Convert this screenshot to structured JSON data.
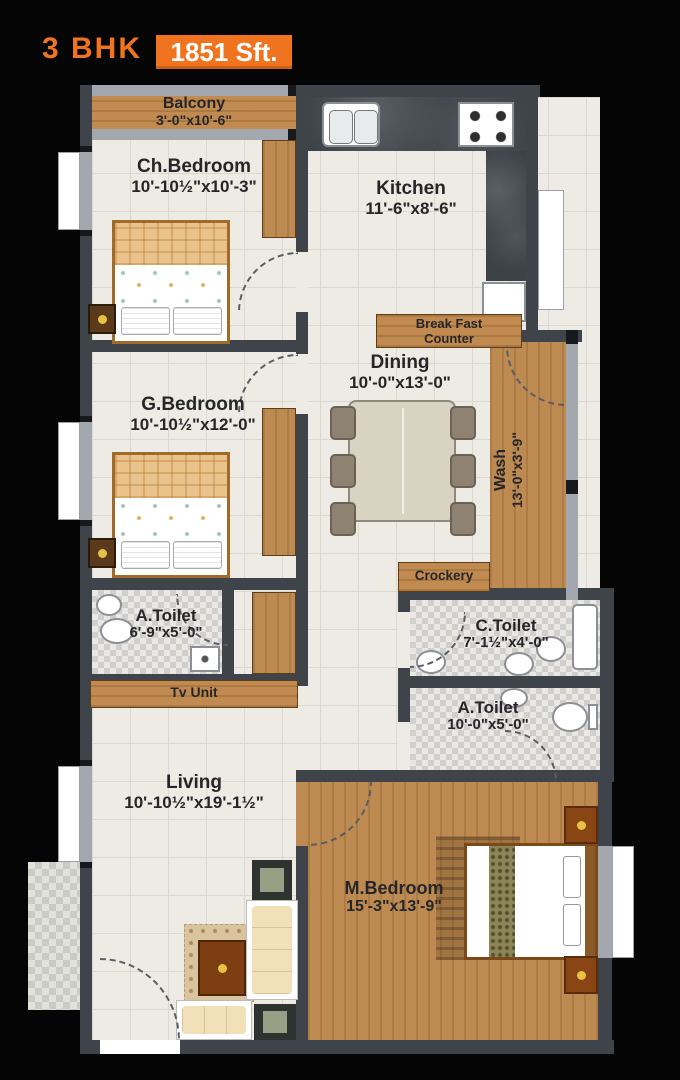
{
  "title": {
    "bhk": "3 BHK",
    "area": "1851 Sft."
  },
  "colors": {
    "accent": "#f0741f",
    "wall": "#3f444b",
    "wood": "#c08a50",
    "tile": "#edebe4"
  },
  "rooms": {
    "balcony": {
      "name": "Balcony",
      "dims": "3'-0\"x10'-6\""
    },
    "ch_bedroom": {
      "name": "Ch.Bedroom",
      "dims": "10'-10½\"x10'-3\""
    },
    "kitchen": {
      "name": "Kitchen",
      "dims": "11'-6\"x8'-6\""
    },
    "breakfast": {
      "line1": "Break Fast",
      "line2": "Counter"
    },
    "dining": {
      "name": "Dining",
      "dims": "10'-0\"x13'-0\""
    },
    "g_bedroom": {
      "name": "G.Bedroom",
      "dims": "10'-10½\"x12'-0\""
    },
    "wash": {
      "name": "Wash",
      "dims": "13'-0\"x3'-9\""
    },
    "crockery": {
      "name": "Crockery"
    },
    "a_toilet_left": {
      "name": "A.Toilet",
      "dims": "6'-9\"x5'-0\""
    },
    "tv_unit": {
      "name": "Tv Unit"
    },
    "c_toilet": {
      "name": "C.Toilet",
      "dims": "7'-1½\"x4'-0\""
    },
    "a_toilet_right": {
      "name": "A.Toilet",
      "dims": "10'-0\"x5'-0\""
    },
    "living": {
      "name": "Living",
      "dims": "10'-10½\"x19'-1½\""
    },
    "m_bedroom": {
      "name": "M.Bedroom",
      "dims": "15'-3\"x13'-9\""
    }
  }
}
